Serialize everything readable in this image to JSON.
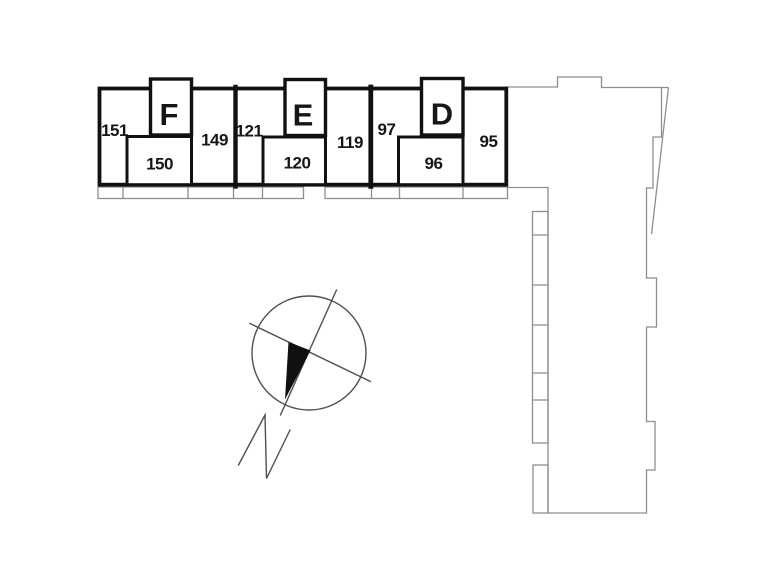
{
  "canvas": {
    "width": 772,
    "height": 580,
    "background": "#ffffff"
  },
  "colors": {
    "wall": "#111111",
    "site_outline": "#8e8e8e",
    "compass_line": "#4f4f4f",
    "needle_fill": "#101010",
    "label_text": "#161616"
  },
  "plan": {
    "blocks": [
      {
        "letter": "F",
        "left_unit": "151",
        "inner_unit": "150",
        "right_unit": "149"
      },
      {
        "letter": "E",
        "left_unit": "121",
        "inner_unit": "120",
        "right_unit": "119"
      },
      {
        "letter": "D",
        "left_unit": "97",
        "inner_unit": "96",
        "right_unit": "95"
      }
    ],
    "compass": {
      "north_label": "N"
    }
  }
}
